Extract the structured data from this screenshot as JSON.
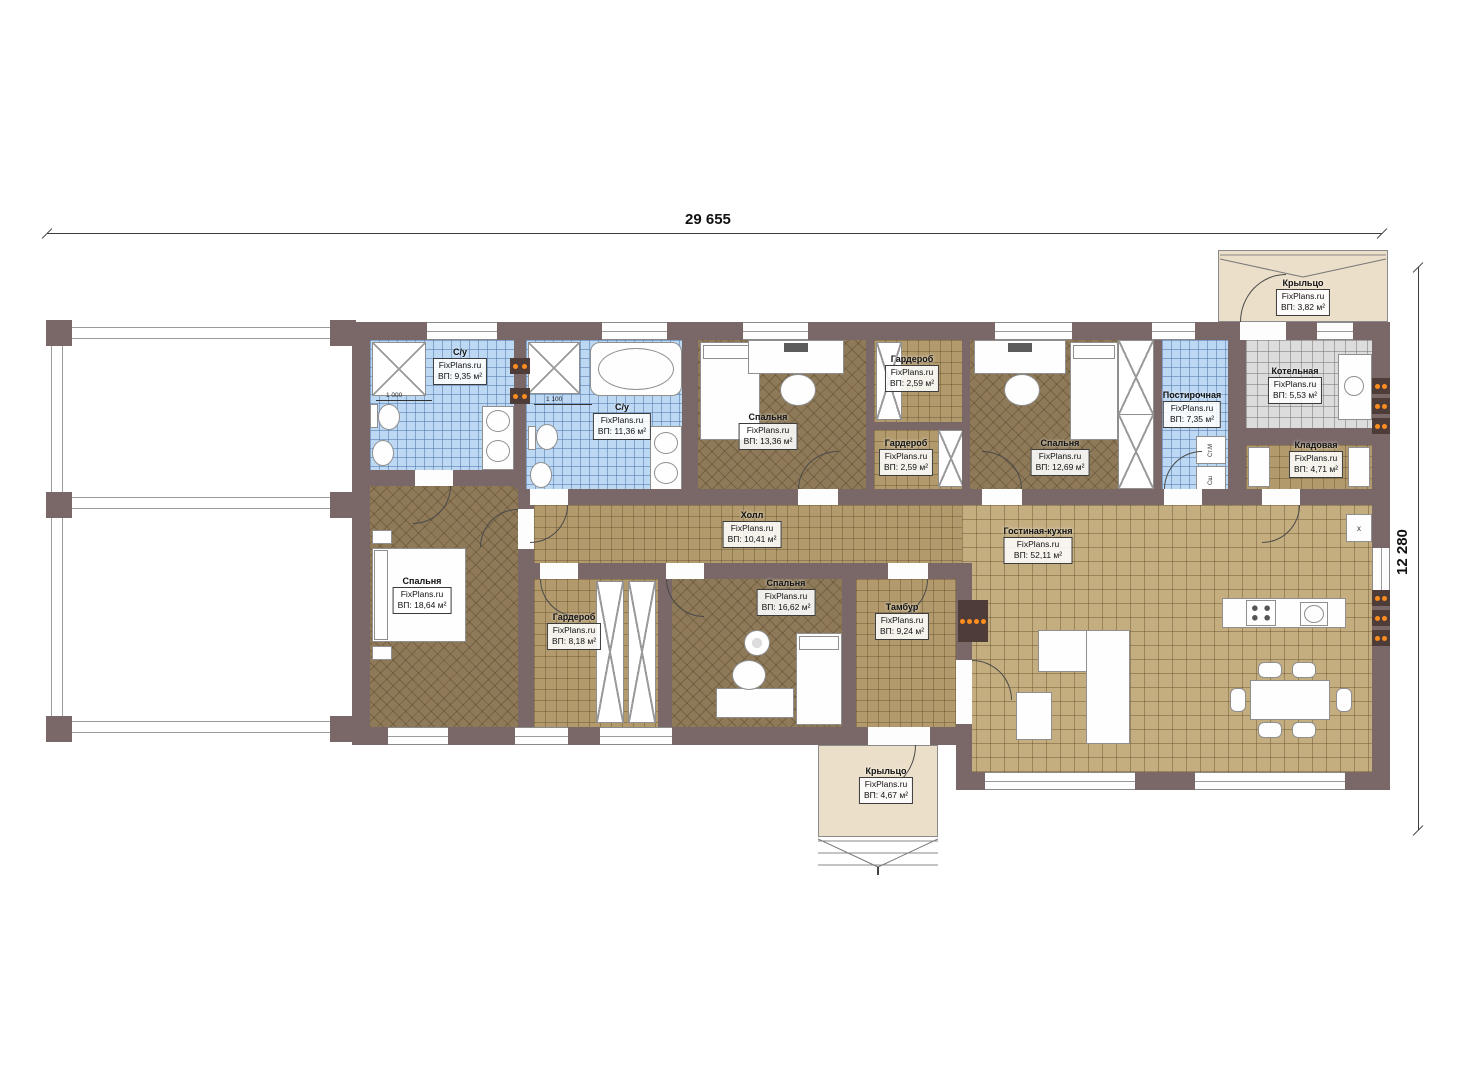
{
  "plan": {
    "watermark": "FixPlans.ru",
    "dim_top": "29 655",
    "dim_right": "12 280",
    "rooms": {
      "su1": {
        "name": "С/у",
        "area": "ВП: 9,35 м²"
      },
      "su2": {
        "name": "С/у",
        "area": "ВП: 11,36 м²"
      },
      "bedroom13": {
        "name": "Спальня",
        "area": "ВП: 13,36 м²"
      },
      "wardrobeT": {
        "name": "Гардероб",
        "area": "ВП: 2,59 м²"
      },
      "wardrobeB": {
        "name": "Гардероб",
        "area": "ВП: 2,59 м²"
      },
      "bedroom12": {
        "name": "Спальня",
        "area": "ВП: 12,69 м²"
      },
      "laundry": {
        "name": "Постирочная",
        "area": "ВП: 7,35 м²"
      },
      "boiler": {
        "name": "Котельная",
        "area": "ВП: 5,53 м²"
      },
      "storage": {
        "name": "Кладовая",
        "area": "ВП: 4,71 м²"
      },
      "porchTop": {
        "name": "Крыльцо",
        "area": "ВП: 3,82 м²"
      },
      "bedroom18": {
        "name": "Спальня",
        "area": "ВП: 18,64 м²"
      },
      "wardrobe8": {
        "name": "Гардероб",
        "area": "ВП: 8,18 м²"
      },
      "hall": {
        "name": "Холл",
        "area": "ВП: 10,41 м²"
      },
      "bedroom16": {
        "name": "Спальня",
        "area": "ВП: 16,62 м²"
      },
      "tambur": {
        "name": "Тамбур",
        "area": "ВП: 9,24 м²"
      },
      "living": {
        "name": "Гостиная-кухня",
        "area": "ВП: 52,11 м²"
      },
      "porchBottom": {
        "name": "Крыльцо",
        "area": "ВП: 4,67 м²"
      }
    },
    "appliances": {
      "washer": "Ст.М",
      "dryer": "Сш",
      "fridge": "x"
    },
    "inner_dims": {
      "bath1": "1 000",
      "bath2": "1 100"
    },
    "colors": {
      "wall": "#7a6767",
      "bath_tile": "#bcd8f3",
      "bedroom_floor": "#8e7a58",
      "parquet": "#b29a6c",
      "living_floor": "#c4ad7f",
      "boiler_tile": "#dcdcdc",
      "porch": "#ecdfc9",
      "heater_accent": "#ff8d1f"
    }
  }
}
